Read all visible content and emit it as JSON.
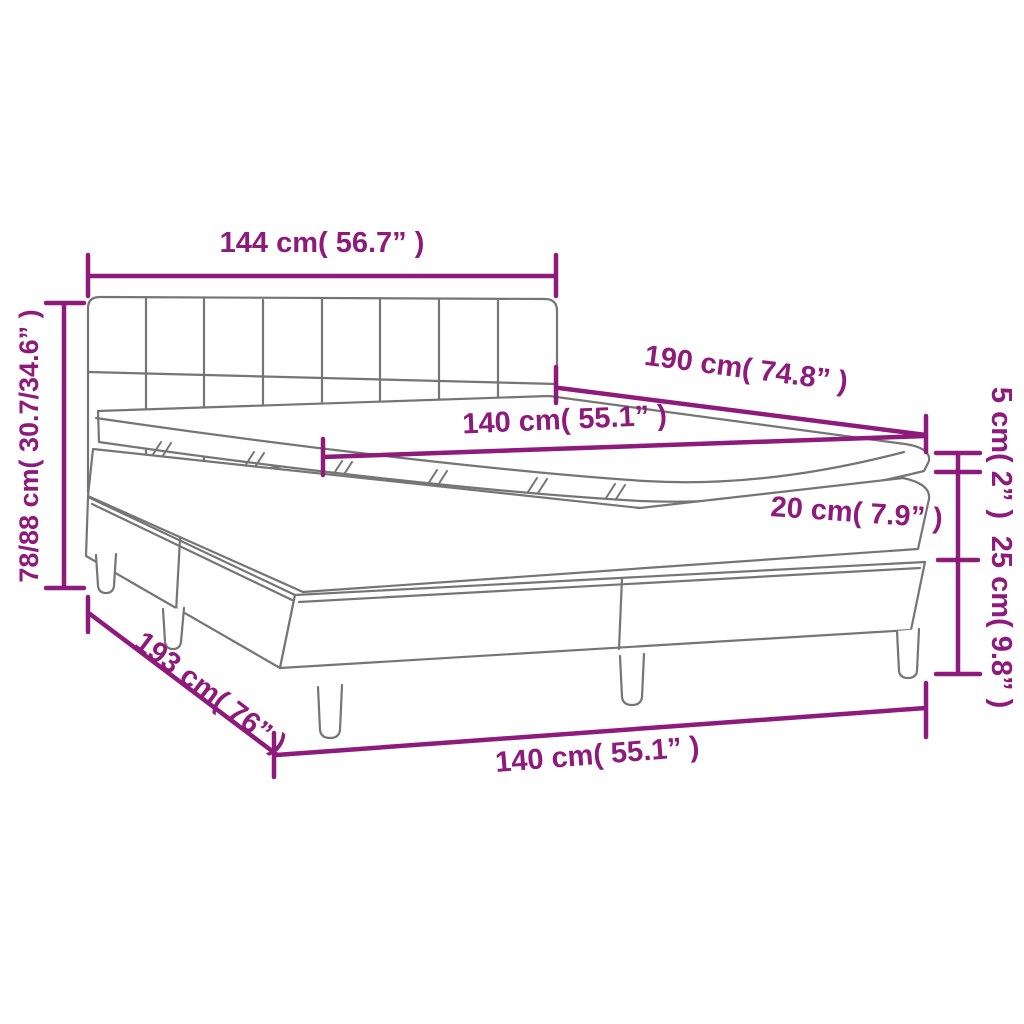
{
  "diagram": {
    "kind": "box-spring-bed-dimension-diagram",
    "colors": {
      "dimension_accent": "#8E1A7B",
      "outline_gray": "#757575",
      "background": "#FFFFFF"
    },
    "labels": {
      "headboard_width": "144 cm( 56.7” )",
      "bed_length": "190 cm( 74.8” )",
      "mattress_width_top": "140 cm( 55.1” )",
      "topper_height": "5 cm( 2” )",
      "mattress_height": "20 cm( 7.9” )",
      "base_height": "25 cm( 9.8” )",
      "total_height": "78/88 cm( 30.7/34.6” )",
      "base_length": "193 cm( 76” )",
      "base_width_bottom": "140 cm( 55.1” )"
    }
  }
}
